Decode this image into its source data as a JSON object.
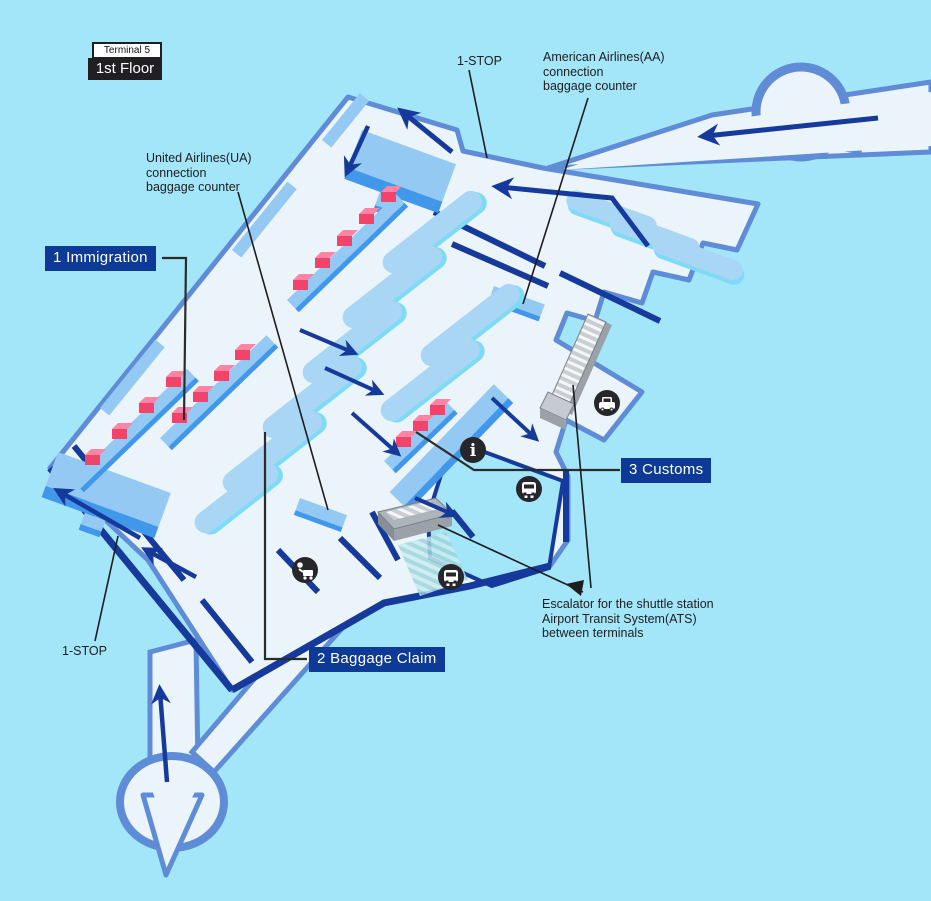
{
  "title_badge": {
    "terminal": "Terminal 5",
    "floor": "1st Floor"
  },
  "labels": {
    "one_stop_top": "1-STOP",
    "one_stop_bottom": "1-STOP",
    "aa_counter_line1": "American Airlines(AA)",
    "aa_counter_line2": "connection",
    "aa_counter_line3": "baggage counter",
    "ua_counter_line1": "United Airlines(UA)",
    "ua_counter_line2": "connection",
    "ua_counter_line3": "baggage counter",
    "escalator_line1": "Escalator for the shuttle station",
    "escalator_line2": "Airport Transit System(ATS)",
    "escalator_line3": "between terminals"
  },
  "callouts": {
    "immigration": "1 Immigration",
    "baggage_claim": "2 Baggage Claim",
    "customs": "3 Customs"
  },
  "icons": {
    "info": "info-icon",
    "info_glyph": "i",
    "bus_upper": "bus-icon",
    "bus_lower": "bus-icon",
    "taxi": "taxi-icon",
    "baggage_cart": "baggage-cart-icon",
    "escalator_upper": "escalator-ramp",
    "escalator_lower": "escalator-ramp"
  },
  "colors": {
    "background": "#A4E6F9",
    "floor": "#EBF3FB",
    "outline_blue": "#5F8CD6",
    "wall_navy": "#16399C",
    "counter_top": "#93C9F3",
    "counter_side": "#4198EA",
    "belt_fill": "#A9D6F4",
    "belt_shadow": "#7EDBF6",
    "booth_top": "#FC84A4",
    "booth_front": "#F2436B",
    "callout_bg": "#0C3A96",
    "callout_text": "#FFFFFF",
    "label_text": "#1D1D1F",
    "icon_bg": "#26262B"
  }
}
